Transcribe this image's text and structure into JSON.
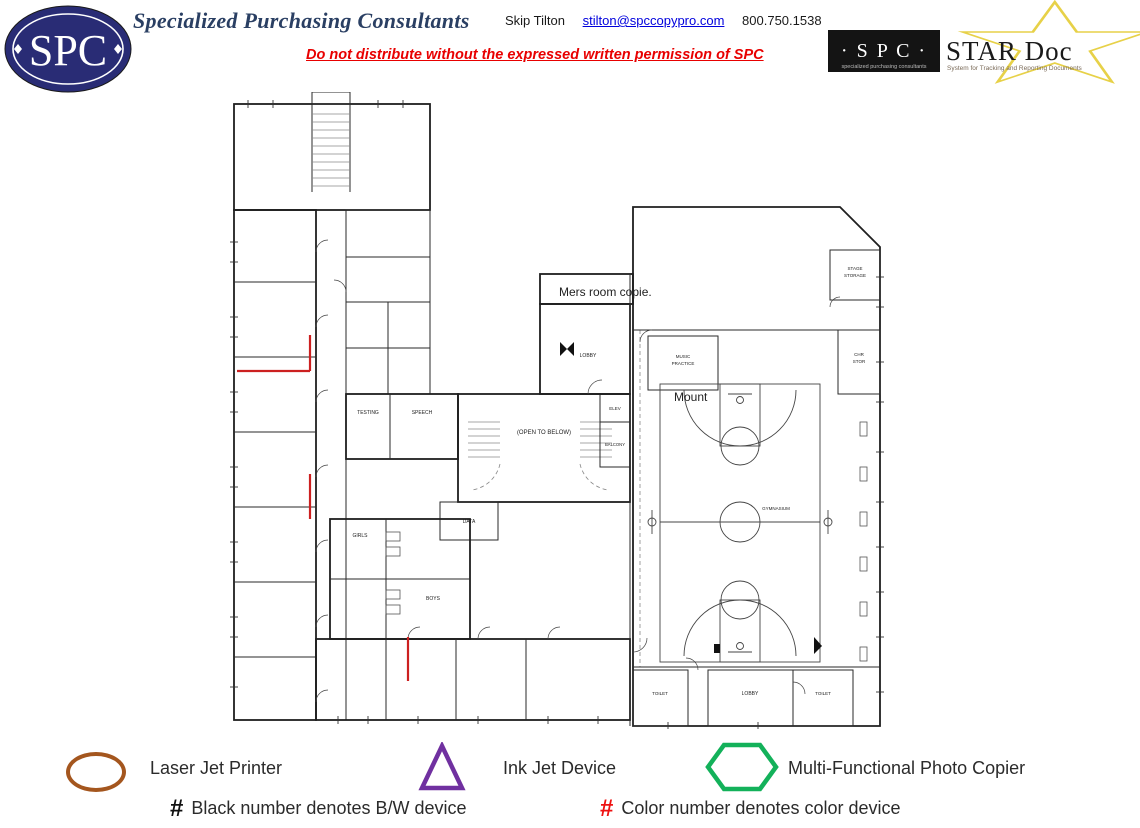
{
  "header": {
    "logo_text": "SPC",
    "title": "Specialized Purchasing Consultants",
    "contact": {
      "name": "Skip Tilton",
      "email": "stilton@spccopypro.com",
      "phone": "800.750.1538"
    },
    "warning": "Do not distribute without the expressed written permission of SPC",
    "stardoc": {
      "spc": "· S P C ·",
      "spc_caption": "specialized purchasing consultants",
      "title": "STAR Doc",
      "caption": "System for Tracking and Reporting Documents",
      "star_color": "#e7d148"
    }
  },
  "plan": {
    "annotations": {
      "copier_note": "Mers room copie.",
      "mount_note": "Mount"
    },
    "labels": {
      "open_to_below": "(OPEN TO BELOW)",
      "lobby_upper": "LOBBY",
      "music_practice_1": "MUSIC",
      "music_practice_2": "PRACTICE",
      "stage_storage_1": "STAGE",
      "stage_storage_2": "STORAGE",
      "chair_storage_1": "CHR",
      "chair_storage_2": "STOR",
      "balcony": "BALCONY",
      "elev": "ELEV",
      "testing": "TESTING",
      "speech": "SPEECH",
      "data": "DATA",
      "girls": "GIRLS",
      "boys": "BOYS",
      "gymnasium": "GYMNASIUM",
      "toilet_left": "TOILET",
      "lobby_lower": "LOBBY",
      "toilet_right": "TOILET"
    }
  },
  "legend": {
    "items": [
      {
        "shape": "ellipse",
        "color": "#a4561e",
        "label": "Laser Jet Printer"
      },
      {
        "shape": "triangle",
        "color": "#7030a0",
        "label": "Ink Jet Device"
      },
      {
        "shape": "hexagon",
        "color": "#13b15a",
        "label": "Multi-Functional Photo Copier"
      }
    ],
    "notes": [
      {
        "symbol": "#",
        "color": "#111111",
        "label": "Black number denotes B/W device"
      },
      {
        "symbol": "#",
        "color": "#ee1111",
        "label": "Color number denotes color device"
      }
    ]
  }
}
